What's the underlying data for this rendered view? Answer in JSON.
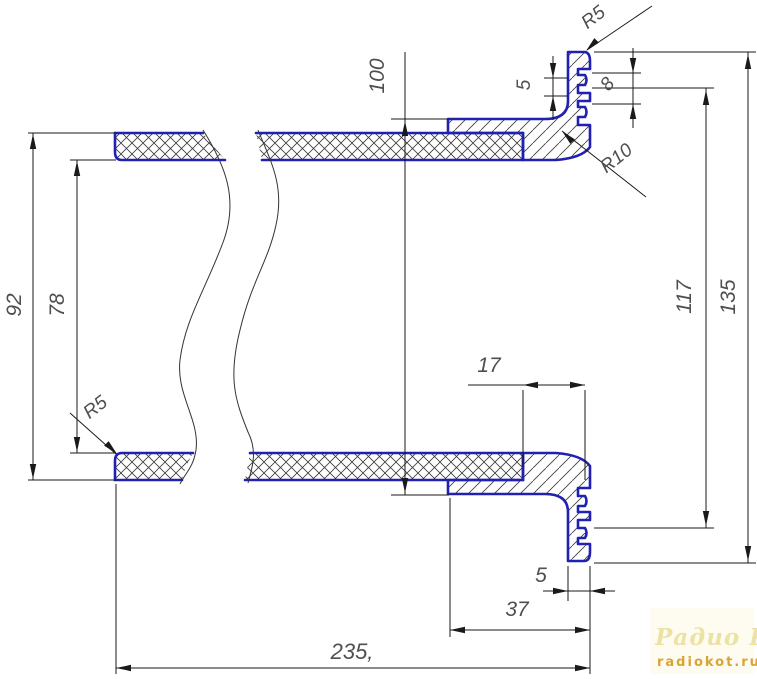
{
  "drawing": {
    "dimensions": {
      "outer_diameter": "92",
      "inner_diameter": "78",
      "collar_outer_diameter": "100",
      "flange_diameter": "135",
      "groove_diameter": "117",
      "groove_pitch": "8",
      "lip_offset_top": "5",
      "rim_thickness_bottom": "5",
      "tube_end_to_face": "17",
      "collar_length": "37",
      "overall_length": "235,"
    },
    "radius_labels": {
      "edge_radius_top": "R5",
      "edge_radius_bottom": "R5",
      "fillet_radius": "R10"
    },
    "colors": {
      "outline": "#2020b2",
      "hatch": "#3a3a3a",
      "dimension": "#1a1a1a",
      "text": "#4f4f4f",
      "watermark_title": "#ece2a4",
      "watermark_url": "#d9a433",
      "background": "#ffffff"
    }
  },
  "watermark": {
    "title": "Радио КОТ",
    "url": "radiokot.ru"
  }
}
